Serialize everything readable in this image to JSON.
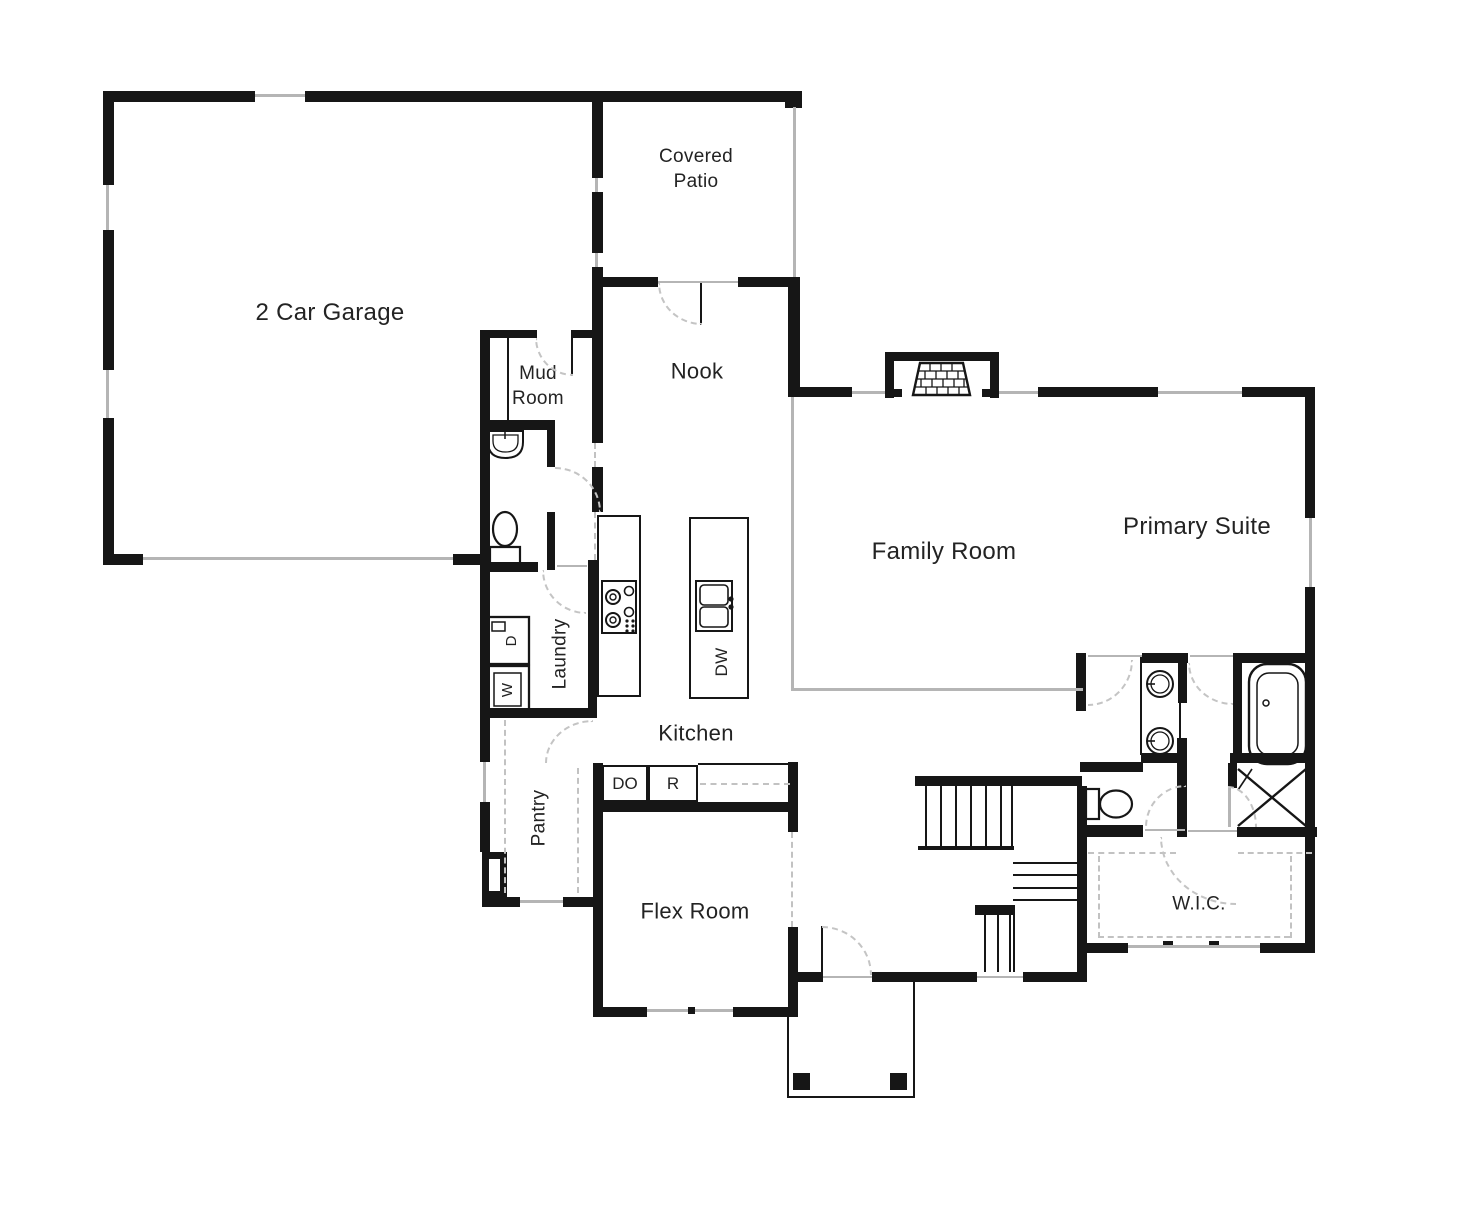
{
  "plan": {
    "rooms": {
      "garage": "2 Car Garage",
      "covered_patio": "Covered Patio",
      "mud_room": "Mud Room",
      "nook": "Nook",
      "family_room": "Family Room",
      "primary_suite": "Primary Suite",
      "laundry": "Laundry",
      "kitchen": "Kitchen",
      "pantry": "Pantry",
      "flex_room": "Flex Room",
      "wic": "W.I.C."
    },
    "appliances": {
      "dishwasher": "DW",
      "double_oven": "DO",
      "range": "R",
      "washer": "W",
      "dryer": "D"
    },
    "colors": {
      "wall": "#161616",
      "window_line": "#b5b5b5",
      "dashed_line": "#c2c2c2",
      "label_text": "#232323"
    }
  }
}
